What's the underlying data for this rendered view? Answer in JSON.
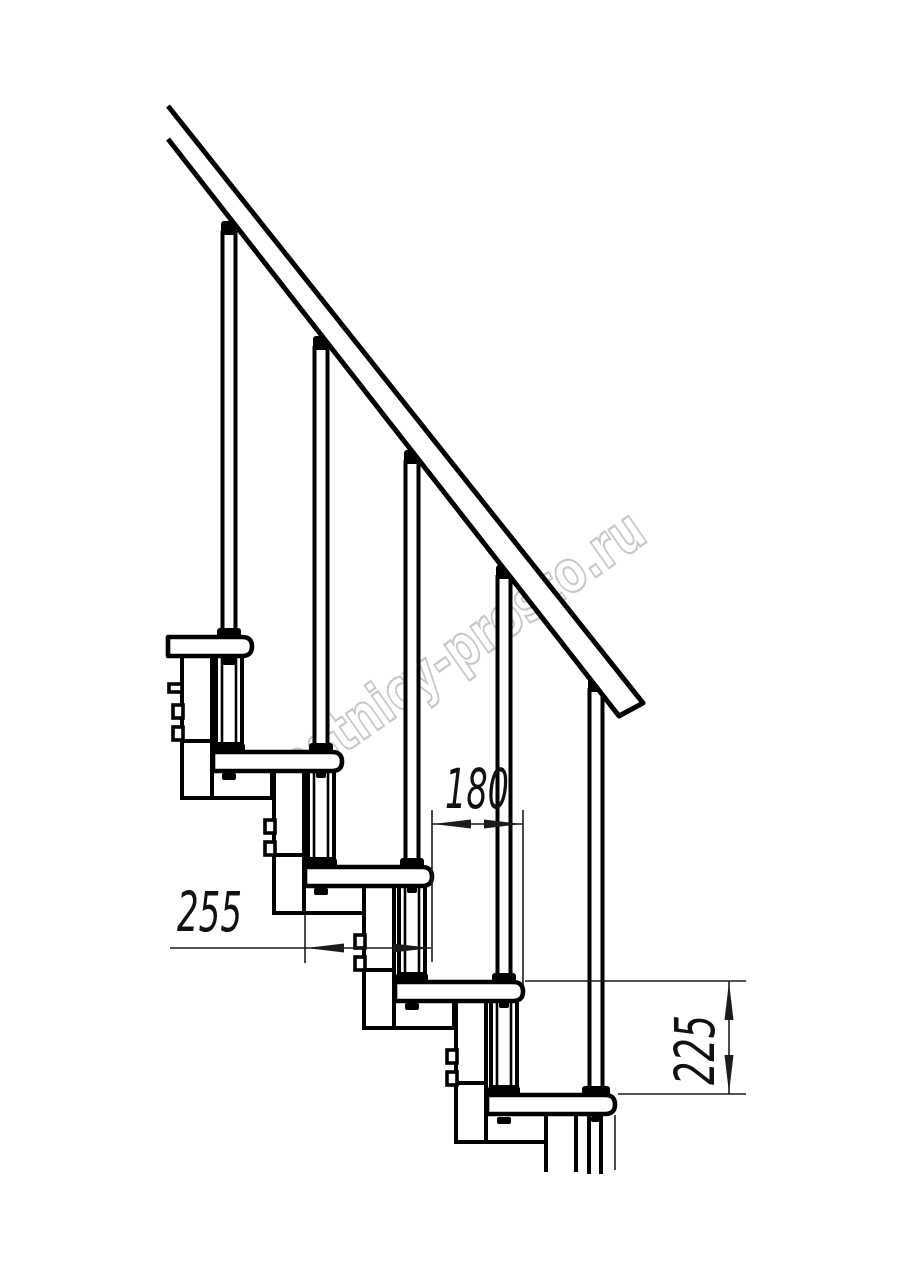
{
  "drawing": {
    "type": "staircase-side-view-technical-drawing",
    "colors": {
      "background": "#ffffff",
      "line": "#000000",
      "dimension_line": "#1c1c1c",
      "watermark": "#c7c7c7"
    }
  },
  "dimension_labels": {
    "tread_depth": "255",
    "tread_overlap": "180",
    "step_rise": "225"
  },
  "watermark": {
    "text": "lestnicy-prosto.ru"
  }
}
